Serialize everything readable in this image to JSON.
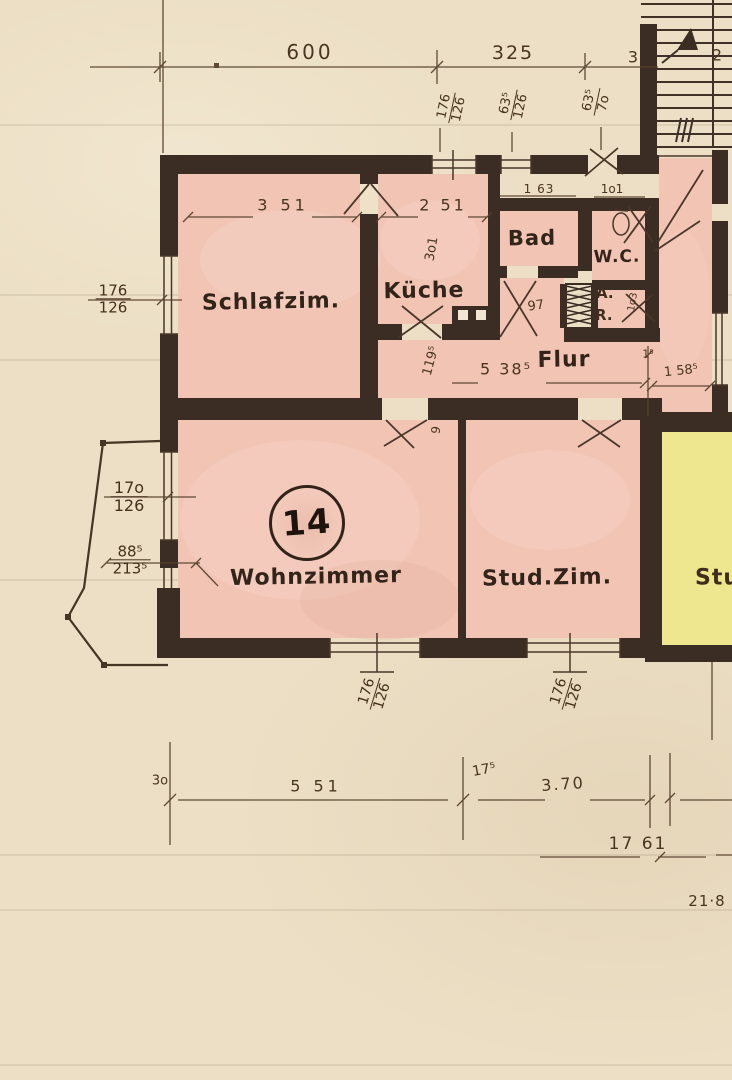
{
  "plan": {
    "rooms": {
      "schlafzimmer": "Schlafzim.",
      "kueche": "Küche",
      "bad": "Bad",
      "wc": "W.C.",
      "abstellraum_line1": "A.",
      "abstellraum_line2": "R.",
      "flur": "Flur",
      "wohnzimmer": "Wohnzimmer",
      "studierzimmer": "Stud.Zim.",
      "studierzimmer_right_partial": "Stud"
    },
    "unit_number": "14",
    "dimensions": {
      "top_width_left": "600",
      "top_width_right": "325",
      "top_small_mid": "3",
      "top_small_right": "2",
      "schlafzimmer_width": "3 51",
      "kueche_width": "2 51",
      "kueche_depth": "3o1",
      "bad_width": "1 63",
      "wc_width": "1o1",
      "bad_door": "97",
      "flur_length": "5 38⁵",
      "flur_width": "119⁵",
      "corridor_small": "1⁵",
      "corridor_width": "1 58⁵",
      "ar_depth": "1o3",
      "door_width": "9",
      "bottom_left_small": "3o",
      "bottom_width_left": "5 51",
      "bottom_small_mid": "17⁵",
      "bottom_width_right": "3.70",
      "bottom_total": "17 61",
      "bottom_corner": "21·8"
    },
    "window_fractions": {
      "top1": {
        "num": "176",
        "den": "126"
      },
      "top2": {
        "num": "63⁵",
        "den": "126"
      },
      "top3": {
        "num": "63⁵",
        "den": "7o"
      },
      "left": {
        "num": "176",
        "den": "126"
      },
      "bay_upper": {
        "num": "17o",
        "den": "126"
      },
      "bay_lower": {
        "num": "88⁵",
        "den": "213⁵"
      },
      "bottom1": {
        "num": "176",
        "den": "126"
      },
      "bottom2": {
        "num": "176",
        "den": "126"
      }
    },
    "colors": {
      "paper": "#ecdfc5",
      "wall": "#3b2d24",
      "room_pink": "#f2c4b4",
      "room_yellow": "#efe78f",
      "ink": "#46311d"
    }
  }
}
